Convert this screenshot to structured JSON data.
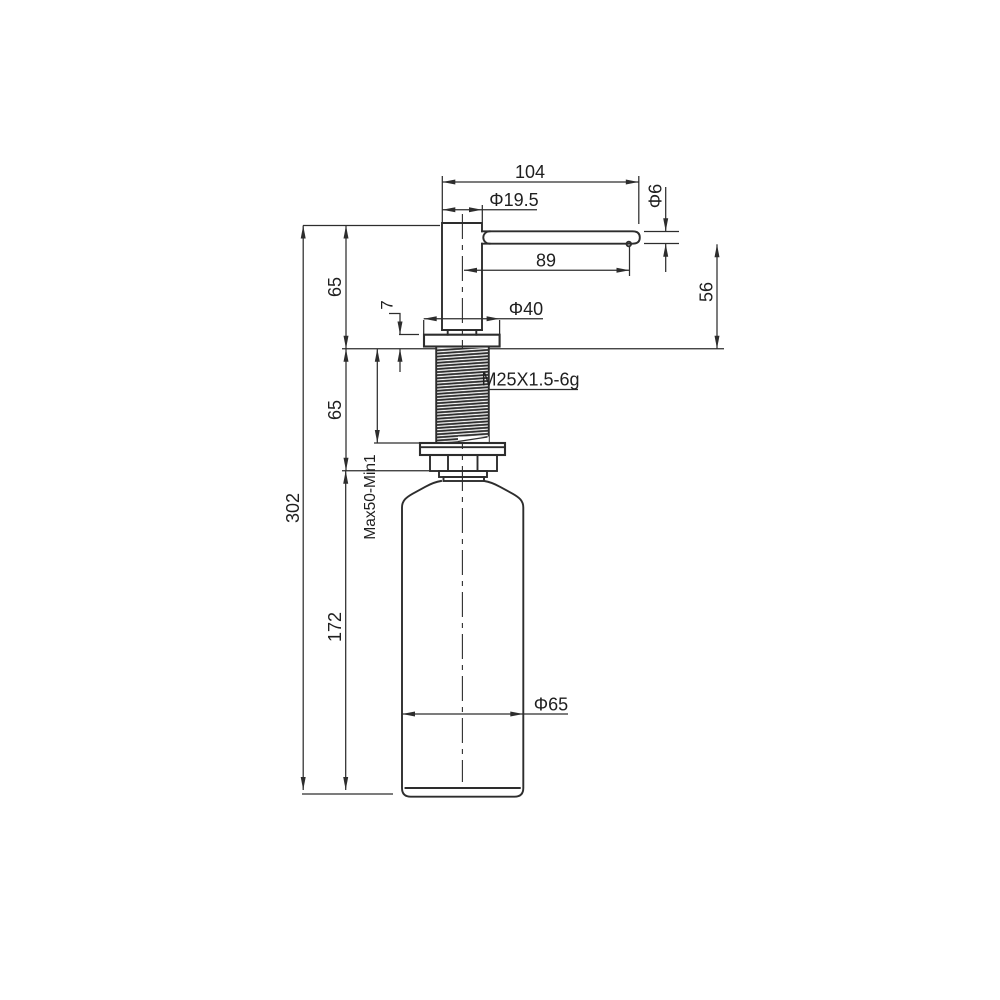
{
  "drawing": {
    "type": "technical-dimension-drawing",
    "subject": "deck-mounted soap dispenser pump with under-counter bottle",
    "colors": {
      "background": "#ffffff",
      "line": "#2d2d2d",
      "text": "#1f1f1f"
    },
    "labels": {
      "spout_overall_length": "104",
      "head_diameter": "Φ19.5",
      "spout_tip_diameter": "Φ6",
      "spout_reach": "89",
      "spout_height_above_deck": "56",
      "head_height": "65",
      "flange_thickness": "7",
      "flange_diameter": "Φ40",
      "thread_spec": "M25X1.5-6g",
      "thread_length": "65",
      "deck_thickness_range": "Max50-Min1",
      "overall_height": "302",
      "bottle_height": "172",
      "bottle_diameter": "Φ65"
    }
  }
}
